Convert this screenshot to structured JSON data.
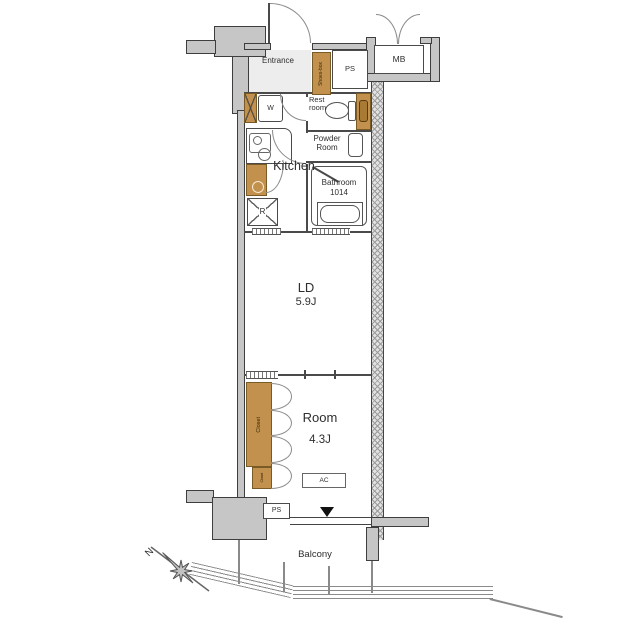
{
  "labels": {
    "entrance": "Entrance",
    "shoes_box": "Shoes-box",
    "ps_top": "PS",
    "mb": "MB",
    "washer": "W",
    "rest_room": "Rest room",
    "powder_room": "Powder Room",
    "kitchen": "Kitchen",
    "bathroom_name": "Bathroom",
    "bathroom_size": "1014",
    "refrigerator": "R",
    "ld_name": "LD",
    "ld_size": "5.9J",
    "room_name": "Room",
    "room_size": "4.3J",
    "closet_main": "Closet",
    "closet_sub": "Closet",
    "ac": "AC",
    "ps_bottom": "PS",
    "balcony": "Balcony",
    "north": "N"
  },
  "colors": {
    "wall_gray": "#c6c6c6",
    "fixture_brown": "#c2914d",
    "door_leaf_brown": "#a87a33",
    "outline": "#444444",
    "text": "#2e2e2e",
    "background": "#ffffff"
  }
}
